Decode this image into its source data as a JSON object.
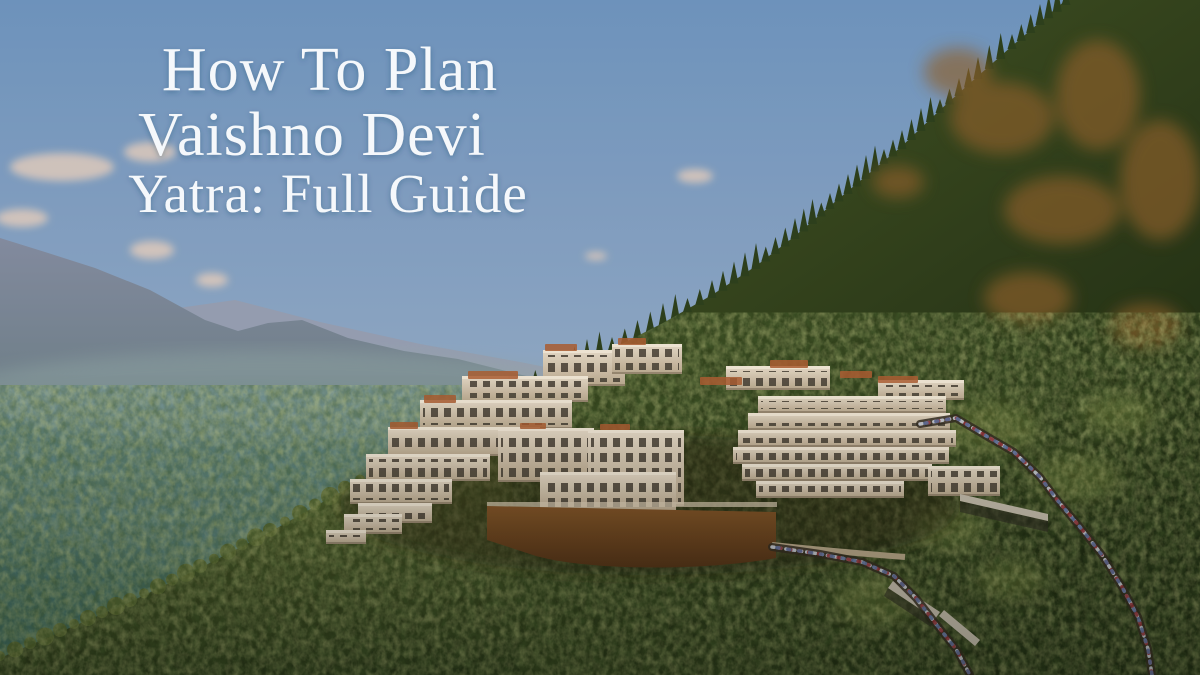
{
  "title": {
    "line1": "How To Plan",
    "line2": "Vaishno Devi",
    "line3": "Yatra: Full Guide"
  },
  "scene": {
    "description": "Aerial photograph of the white terraced Vaishno Devi shrine complex on a forested Trikuta mountainside, with hazy blue valley ridges to the left and a winding pilgrim path crowded with devotees descending to the right",
    "colors": {
      "sky_top": "#6a92c0",
      "sky_mid": "#8ba6c6",
      "sky_horizon": "#abaebd",
      "cloud": "#ecd2bf",
      "far_mountain": "#7f8aa2",
      "far_mountain_low": "#47695e",
      "distant_ridge": "#949cb0",
      "valley_top": "#5b8288",
      "valley_low": "#35655a",
      "forest_light": "#5c6c31",
      "forest_low": "#1f2f14",
      "mountain_sun": "#415626",
      "mountain_shadow": "#16240e",
      "treeline": "#273c1b",
      "autumn_patch": "#8d5f2b",
      "olive_patch": "#6b7a38",
      "building_light": "#e3d9c9",
      "building_shade": "#b7a78f",
      "window_dark": "#403a31",
      "roof_orange": "#a85a30",
      "wall_light": "#7c5026",
      "wall_dark": "#4f2f15",
      "path_light": "#b3a489",
      "shed_roof": "#c2bcae",
      "crowd_white": "#ccd2de",
      "crowd_red": "#8e3038",
      "crowd_blue": "#5b6f9e",
      "title_color": "#f5f8fb"
    }
  }
}
